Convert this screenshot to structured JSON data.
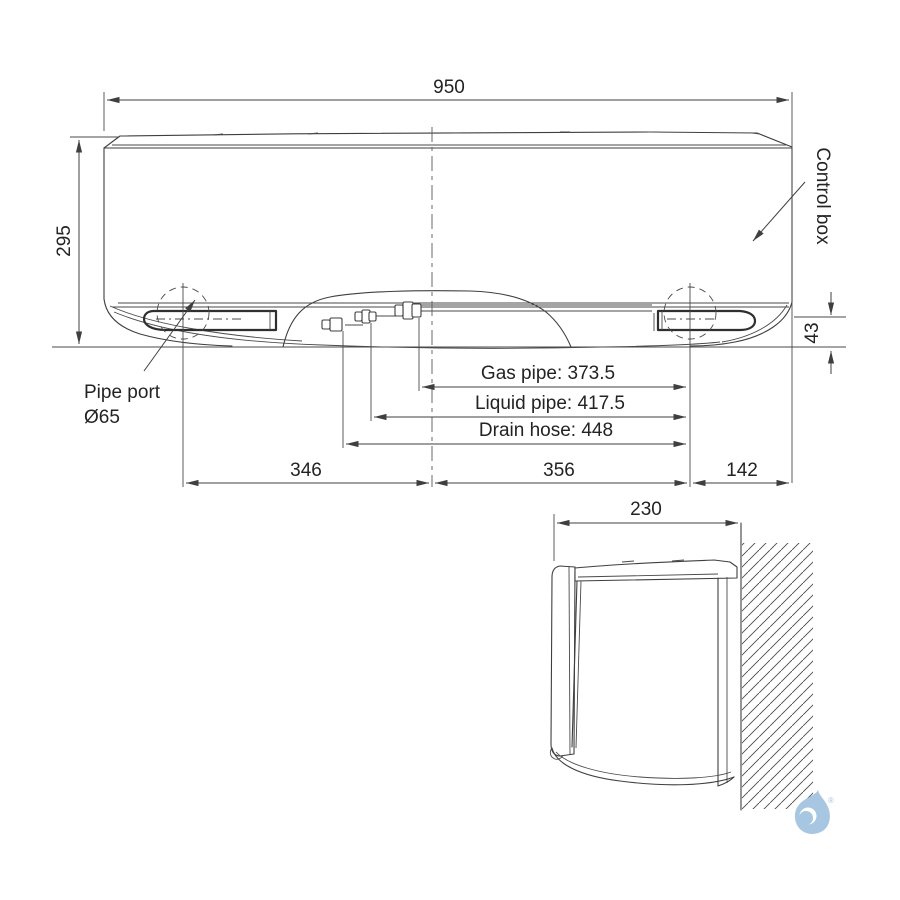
{
  "colors": {
    "line": "#3f3f3f",
    "text": "#232323",
    "logo_blue": "#a6c6e2",
    "background": "#ffffff"
  },
  "front_view": {
    "width": "950",
    "height": "295",
    "bottom_right_height": "43",
    "control_box": "Control box",
    "pipe_port": {
      "line1": "Pipe port",
      "line2": "Ø65"
    },
    "gas_pipe": "Gas pipe: 373.5",
    "liquid_pipe": "Liquid pipe: 417.5",
    "drain_hose": "Drain hose: 448",
    "offset_left": "346",
    "offset_center": "356",
    "offset_right": "142"
  },
  "side_view": {
    "depth": "230"
  },
  "logo": {
    "registered_mark": "®"
  }
}
